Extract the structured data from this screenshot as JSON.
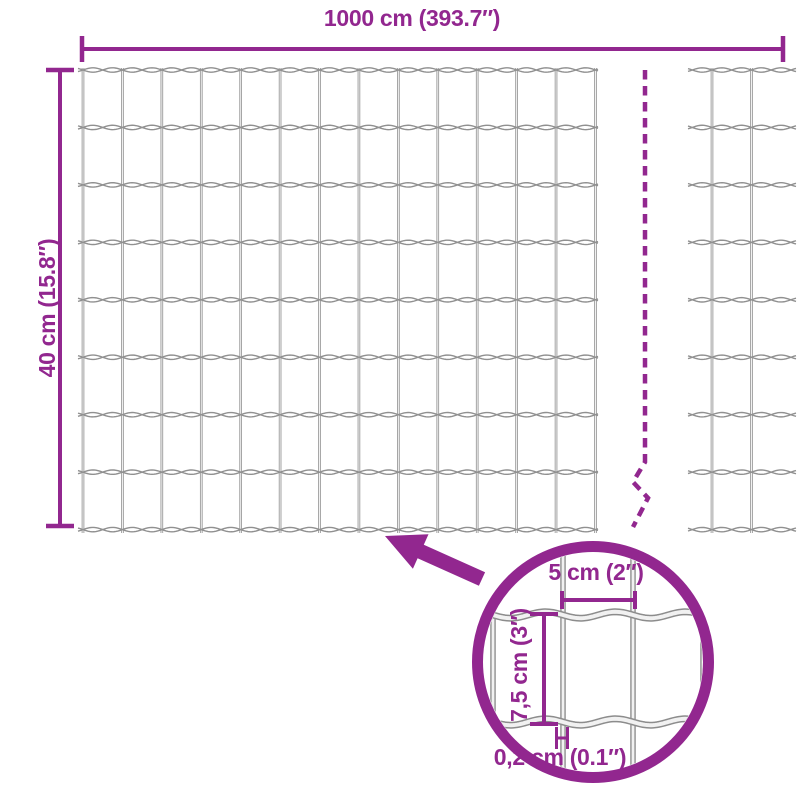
{
  "diagram": {
    "subject": "wire-mesh-fence-dimension-diagram",
    "width_label": "1000 cm (393.7″)",
    "height_label": "40 cm (15.8″)",
    "detail": {
      "cell_width_label": "5 cm (2″)",
      "cell_height_label": "7,5 cm (3″)",
      "wire_thickness_label": "0,2 cm (0.1″)"
    },
    "colors": {
      "accent": "#92278F",
      "wire_dark": "#8C8C8C",
      "wire_mid": "#909090",
      "wire_light": "#F1F1F1",
      "background": "#FFFFFF"
    }
  }
}
